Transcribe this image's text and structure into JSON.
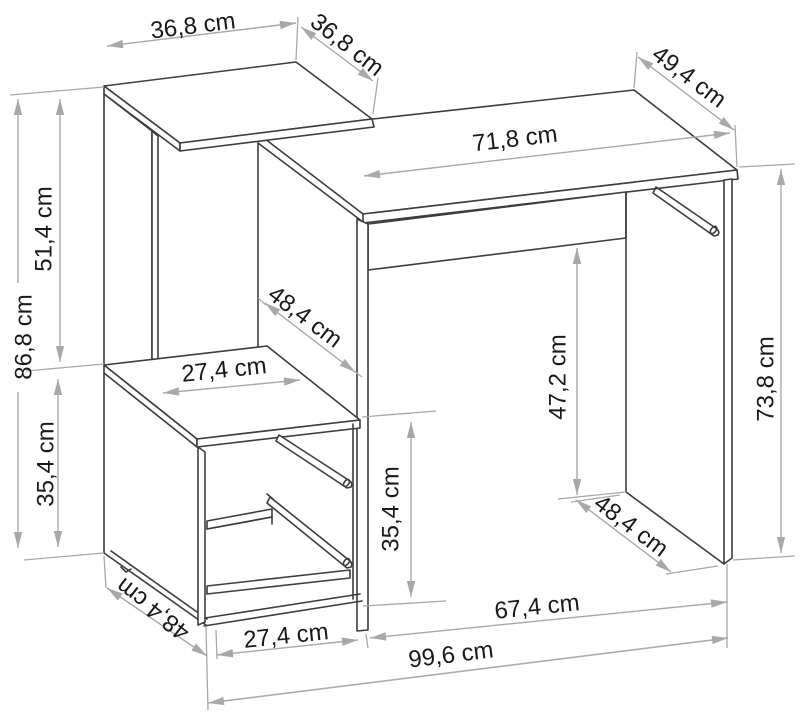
{
  "drawing": {
    "type": "furniture-dimension-diagram",
    "subject": "desk with side shelf and cabinet unit",
    "units": "cm",
    "line_color": "#3d3d3d",
    "dimension_color": "#a8a8a8",
    "text_color": "#191919"
  },
  "dims": {
    "shelf_top_width": "36,8 cm",
    "shelf_top_depth": "36,8 cm",
    "desktop_depth": "49,4 cm",
    "desktop_width": "71,8 cm",
    "shelf_upper_height": "51,4 cm",
    "shelf_total_height": "86,8 cm",
    "cabinet_height_left": "35,4 cm",
    "support_panel_depth": "48,4 cm",
    "shelf_clear_width": "27,4 cm",
    "under_desk_clearance": "47,2 cm",
    "desk_height": "73,8 cm",
    "cabinet_height_mid": "35,4 cm",
    "cabinet_depth": "48,4 cm",
    "side_panel_depth": "48,4 cm",
    "cabinet_width": "27,4 cm",
    "under_desk_width": "67,4 cm",
    "overall_width": "99,6 cm"
  }
}
